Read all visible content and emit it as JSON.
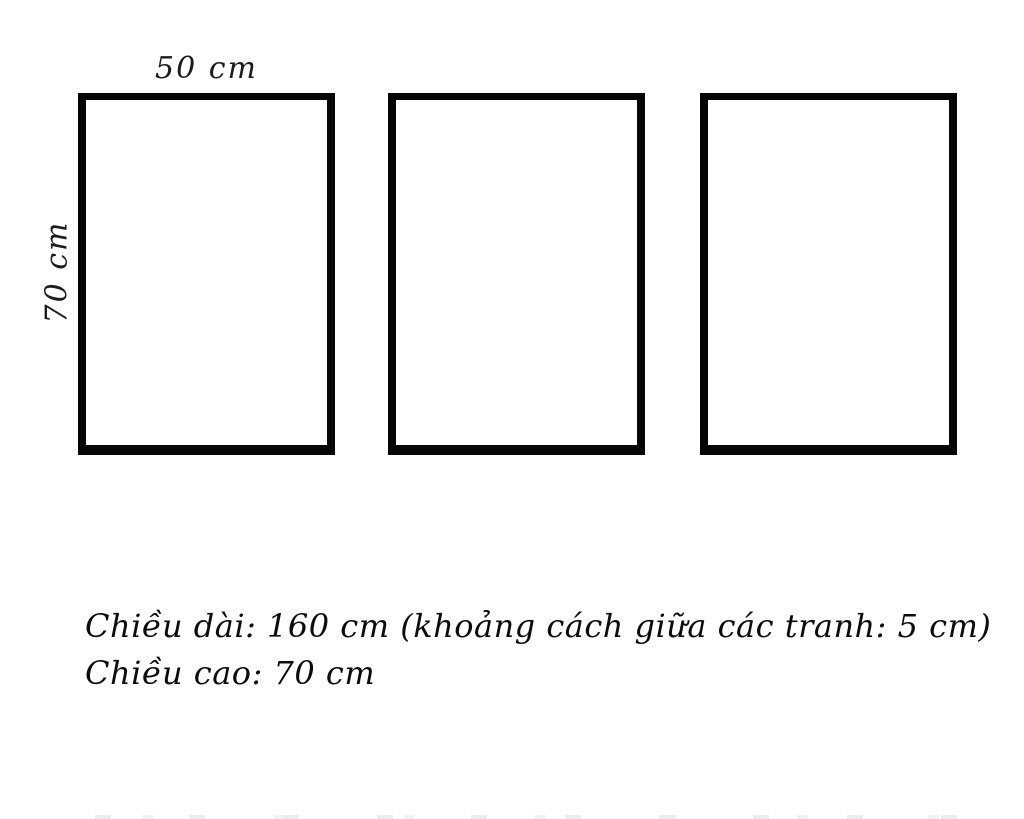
{
  "colors": {
    "background": "#ffffff",
    "frame_border": "#060606",
    "text": "#0c0c0c"
  },
  "labels": {
    "width": "50 cm",
    "height": "70 cm"
  },
  "frames": {
    "count": 3,
    "description": "three identical empty rectangular picture frames in a row"
  },
  "caption": {
    "line1": "Chiều dài: 160 cm (khoảng cách giữa các tranh: 5 cm)",
    "line2": "Chiều cao: 70 cm"
  }
}
